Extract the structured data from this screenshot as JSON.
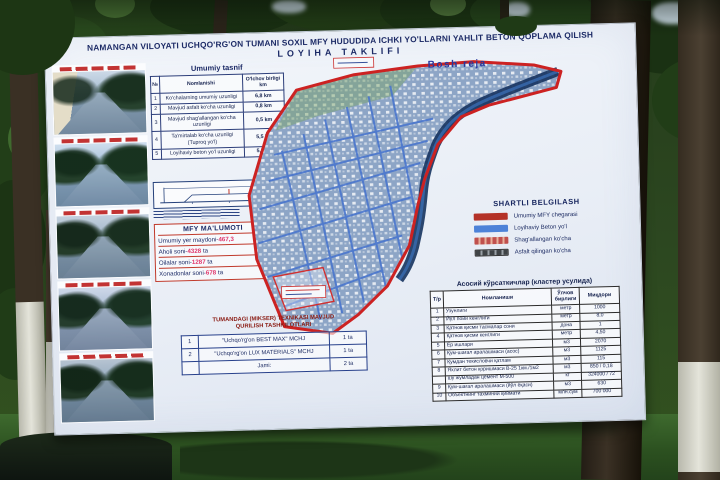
{
  "billboard": {
    "title_line1": "NAMANGAN VILOYATI UCHQO'RG'ON TUMANI SOXIL MFY HUDUDIDA ICHKI YO'LLARNI YAHLIT BETON QOPLAMA QILISH",
    "title_line2": "LOYIHA TAKLIFI",
    "map_label": "Bosh reja",
    "tasnif": {
      "title": "Umumiy tasnif",
      "headers": {
        "num": "№",
        "name": "Nomlanishi",
        "value": "O'lchov birligi km"
      },
      "rows": [
        {
          "num": "1",
          "name": "Ko'chalarning umumiy uzunligi",
          "value": "6,8 km"
        },
        {
          "num": "2",
          "name": "Mavjud asfalt ko'cha uzunligi",
          "value": "0,8 km"
        },
        {
          "num": "3",
          "name": "Mavjud shag'allangan ko'cha uzunligi",
          "value": "0,5 km"
        },
        {
          "num": "4",
          "name": "Ta'mirtalab ko'cha uzunligi (Tuproq yo'l)",
          "value": "5,5 km"
        },
        {
          "num": "5",
          "name": "Loyihaviy beton yo'l uzunligi",
          "value": "5,5 km"
        }
      ]
    },
    "mfy": {
      "title": "MFY MA'LUMOTI",
      "rows": [
        {
          "label": "Umumiy yer maydoni-",
          "value": "467,3",
          "suffix": ""
        },
        {
          "label": "Aholi soni-",
          "value": "4328",
          "suffix": " ta"
        },
        {
          "label": "Oilalar soni-",
          "value": "1287",
          "suffix": " ta"
        },
        {
          "label": "Xonadonlar soni-",
          "value": "678",
          "suffix": " ta"
        }
      ]
    },
    "legend": {
      "title": "SHARTLI BELGILASH",
      "items": [
        {
          "label": "Umumiy MFY chegarasi",
          "color": "#b43228",
          "style": "solid"
        },
        {
          "label": "Loyihaviy Beton yo'l",
          "color": "#4d82d8",
          "style": "solid"
        },
        {
          "label": "Shag'allangan ko'cha",
          "color": "#c0504d",
          "style": "striped"
        },
        {
          "label": "Asfalt qilingan ko'cha",
          "color": "#3f4346",
          "style": "hatched"
        }
      ]
    },
    "tex": {
      "title_line1": "TUMANDAGI (MIKSER) TEXNIKASI MAVJUD",
      "title_line2": "QURILISH TASHKILOTLARI",
      "rows": [
        {
          "num": "1",
          "name": "\"Uchqo'rg'on BEST MAX\" MCHJ",
          "qty": "1 ta"
        },
        {
          "num": "2",
          "name": "\"Uchqo'rg'on LUX MATERIALS\" MCHJ",
          "qty": "1 ta"
        },
        {
          "num": "",
          "name": "Jami:",
          "qty": "2 ta"
        }
      ]
    },
    "kur": {
      "title": "Асосий кўрсаткичлар (кластер усулида)",
      "headers": {
        "num": "Т/р",
        "name": "Номланиши",
        "unit": "Ўлчов бирлиги",
        "qty": "Миқдори"
      },
      "rows": [
        {
          "num": "1",
          "name": "Узунлиги",
          "unit": "метр",
          "qty": "1000"
        },
        {
          "num": "2",
          "name": "Йўл пойи кенглиги",
          "unit": "метр",
          "qty": "8,0"
        },
        {
          "num": "3",
          "name": "Қатнов қисми тасмалар сони",
          "unit": "дона",
          "qty": "1"
        },
        {
          "num": "4",
          "name": "Қатнов қисми кенглиги",
          "unit": "метр",
          "qty": "4,50"
        },
        {
          "num": "5",
          "name": "Ер ишлари",
          "unit": "м3",
          "qty": "2070"
        },
        {
          "num": "6",
          "name": "Қум-шағал аралашмаси (асос)",
          "unit": "м3",
          "qty": "1125"
        },
        {
          "num": "7",
          "name": "Қумдан текисловчи қатлам",
          "unit": "м3",
          "qty": "115"
        },
        {
          "num": "8",
          "name": "Яхлит бетон қоришмаси В-25 1км./1м2",
          "unit": "м3",
          "qty": "850 / 0,18"
        },
        {
          "num": "",
          "name": "шу жумладан цемент М-500",
          "unit": "кг",
          "qty": "324000 / 72"
        },
        {
          "num": "9",
          "name": "Қум-шағал аралашмаси (йўл ёқаси)",
          "unit": "м3",
          "qty": "630"
        },
        {
          "num": "10",
          "name": "Объектнинг тахминий қиймати",
          "unit": "млн.сум",
          "qty": "700 000"
        }
      ]
    },
    "photos": {
      "count": 5
    },
    "colors": {
      "poster_text": "#1c2a66",
      "boundary_red": "#cc2222",
      "map_fill_blue": "#8da5c6",
      "mfy_value_accent": "#e0356b"
    }
  }
}
